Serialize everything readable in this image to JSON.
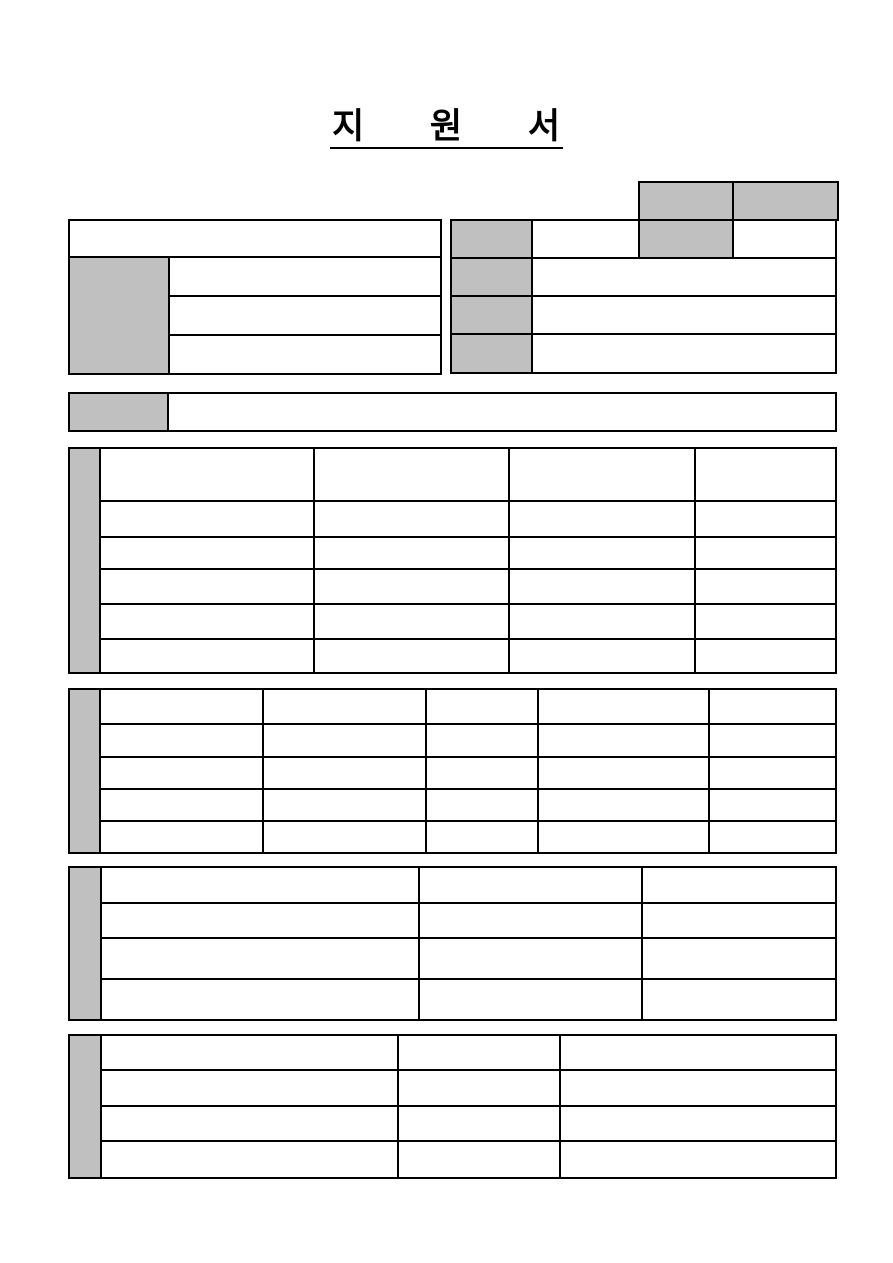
{
  "title": {
    "text": "지 원 서"
  },
  "colors": {
    "header_fill": "#c0c0c0",
    "border": "#000000",
    "page_bg": "#ffffff"
  },
  "form": {
    "cells_empty": true,
    "note_visible_text": "지 원 서"
  }
}
